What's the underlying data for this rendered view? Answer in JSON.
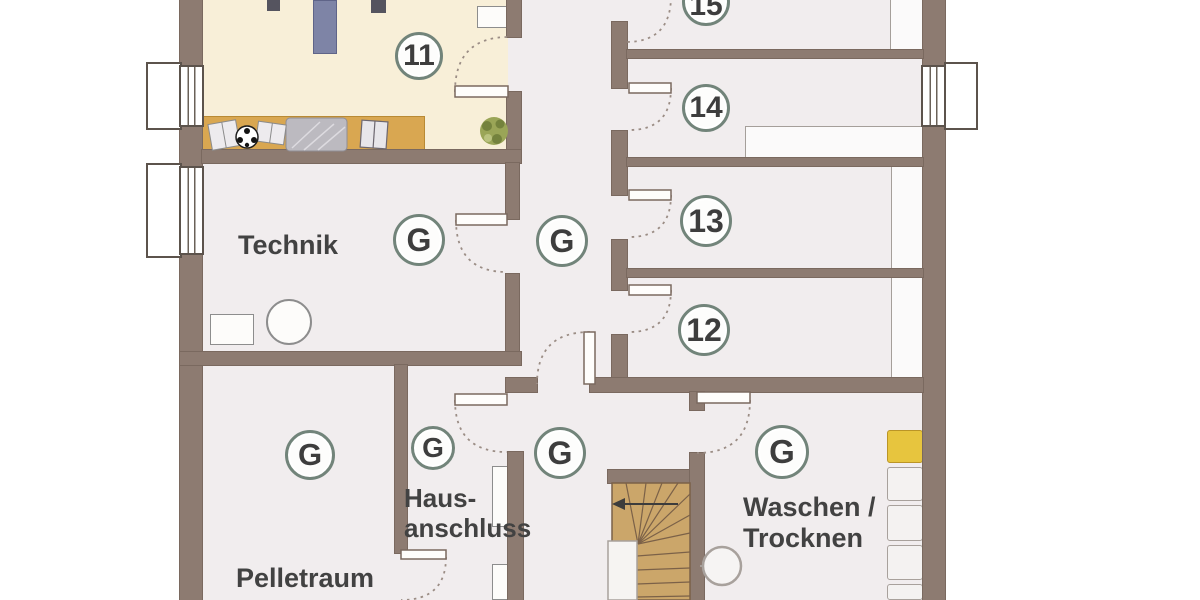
{
  "plan": {
    "figure_type": "basement floor plan (scanned)",
    "compartments": {
      "c11": "11",
      "c12": "12",
      "c13": "13",
      "c14": "14",
      "c15": "15"
    },
    "common_marker": "G",
    "common_marker_locations": [
      "technik",
      "corridor",
      "pelletraum",
      "hausanschluss",
      "stair-hall",
      "waschen-trocknen"
    ],
    "rooms": {
      "technik": "Technik",
      "pelletraum": "Pelletraum",
      "hausanschluss": [
        "Haus-",
        "anschluss"
      ],
      "waschen_trocknen": [
        "Waschen /",
        "Trocknen"
      ]
    },
    "icons": [
      "stairs",
      "stair-direction-arrow",
      "door-swing-arc",
      "door-leaf",
      "window",
      "window-well",
      "plant-icon",
      "soccer-ball-icon",
      "open-book",
      "bed-blanket",
      "desk",
      "boiler-circle",
      "equipment-box",
      "wall-shelf",
      "laundry-box-yellow",
      "drain-circle"
    ],
    "colors": {
      "wall": "#8d7b71",
      "floor": "#f1edee",
      "room11_floor": "#f8efd8",
      "wood": "#d9a751",
      "stairs": "#cba66a",
      "badge_ring": "#72847a",
      "text": "#424242",
      "accent_yellow": "#e7c53e"
    }
  }
}
